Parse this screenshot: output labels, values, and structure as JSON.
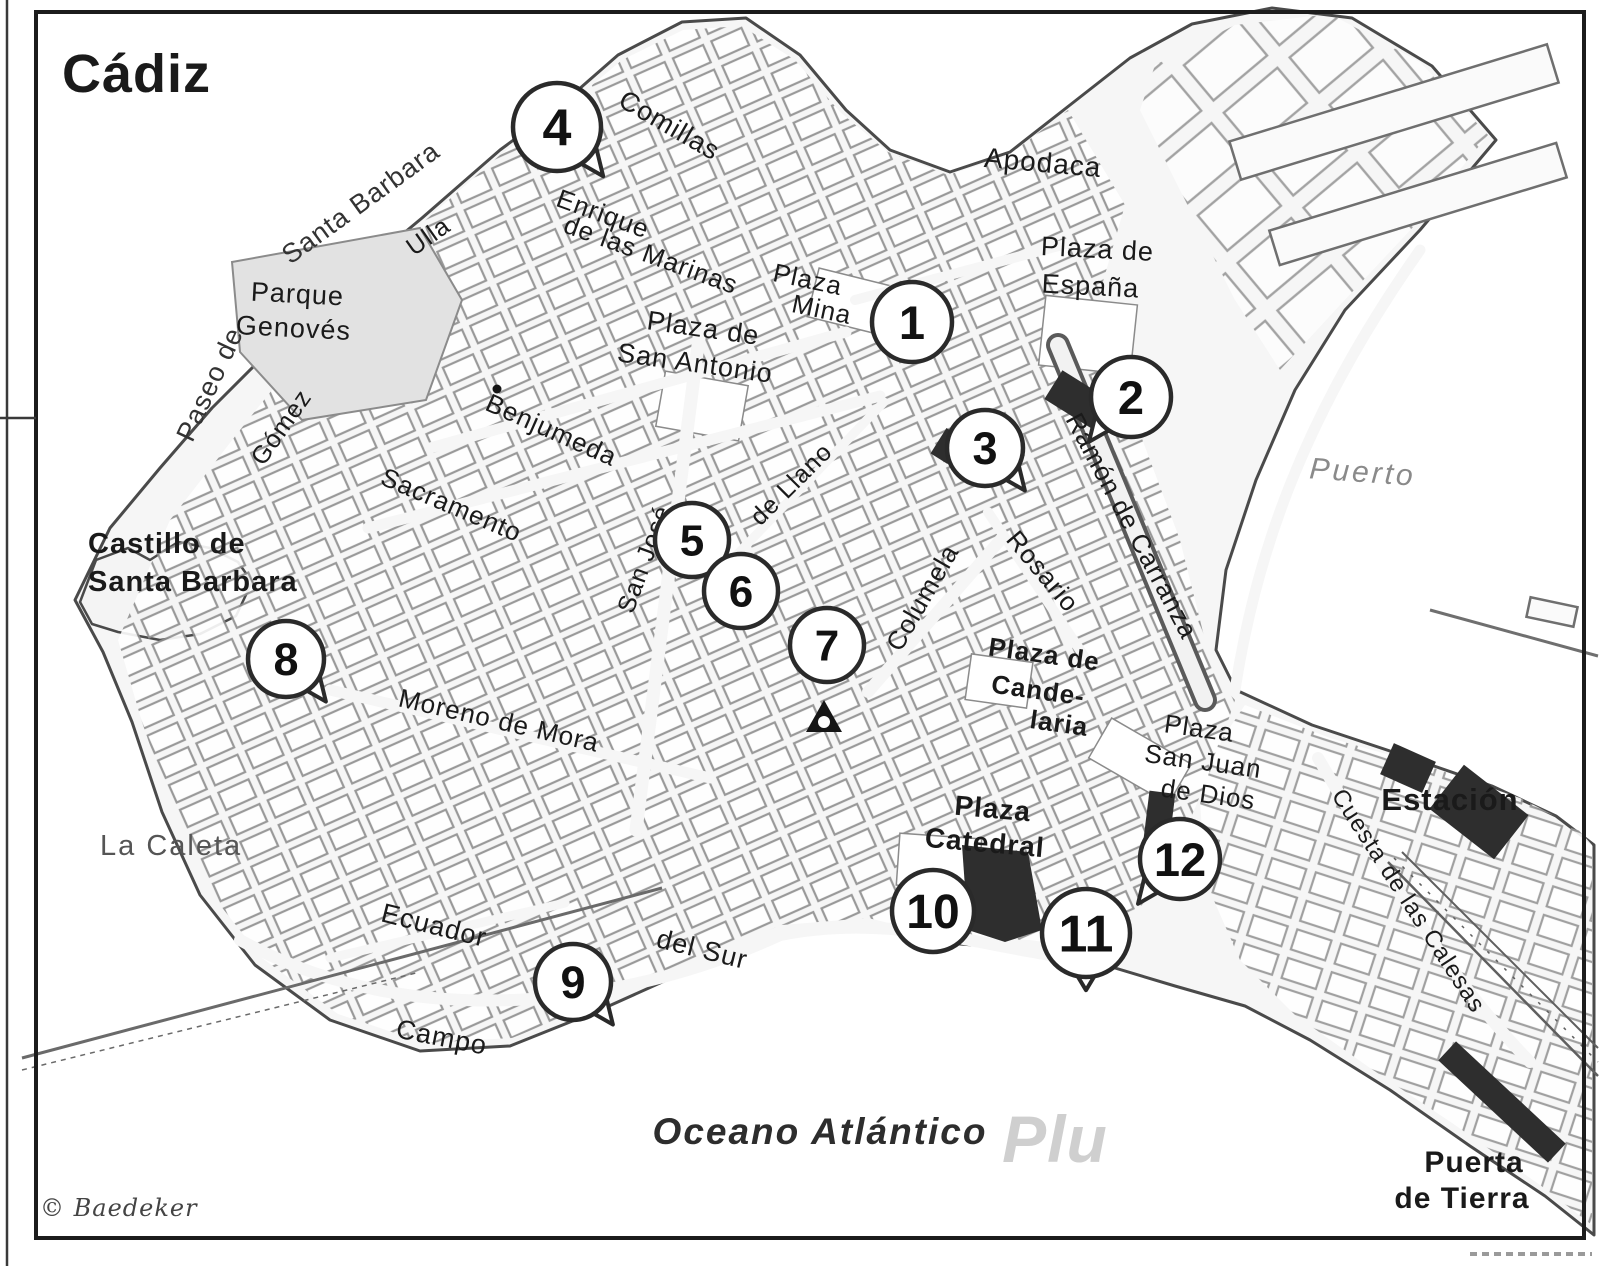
{
  "page": {
    "title": "Cádiz",
    "copyright": "© Baedeker",
    "watermark": "Plu"
  },
  "map": {
    "accent_color": "#2a2a2a",
    "sea_label": "Oceano Atlántico",
    "markers": [
      {
        "n": "1",
        "x": 912,
        "y": 322,
        "r": 40
      },
      {
        "n": "2",
        "x": 1131,
        "y": 397,
        "r": 40,
        "tail": "bl"
      },
      {
        "n": "3",
        "x": 985,
        "y": 448,
        "r": 38,
        "tail": "br"
      },
      {
        "n": "4",
        "x": 557,
        "y": 127,
        "r": 44,
        "tail": "br"
      },
      {
        "n": "5",
        "x": 692,
        "y": 540,
        "r": 37
      },
      {
        "n": "6",
        "x": 741,
        "y": 591,
        "r": 37
      },
      {
        "n": "7",
        "x": 827,
        "y": 645,
        "r": 37
      },
      {
        "n": "8",
        "x": 286,
        "y": 659,
        "r": 38,
        "tail": "br"
      },
      {
        "n": "9",
        "x": 573,
        "y": 982,
        "r": 38,
        "tail": "br"
      },
      {
        "n": "10",
        "x": 933,
        "y": 911,
        "r": 41
      },
      {
        "n": "11",
        "x": 1086,
        "y": 933,
        "r": 44,
        "tail": "b"
      },
      {
        "n": "12",
        "x": 1180,
        "y": 859,
        "r": 40,
        "tail": "bl"
      }
    ],
    "labels": [
      {
        "id": "title",
        "text": "Cádiz",
        "x": 62,
        "y": 92,
        "size": 54,
        "w": 700,
        "anchor": "start",
        "ls": 1
      },
      {
        "id": "paseo-de",
        "text": "Paseo de",
        "x": 218,
        "y": 388,
        "rot": -65,
        "size": 27,
        "fill": "#333333"
      },
      {
        "id": "santa-barbara-street",
        "text": "Santa Barbara",
        "x": 366,
        "y": 210,
        "rot": -36,
        "size": 27,
        "fill": "#333333"
      },
      {
        "id": "ulla",
        "text": "Ulla",
        "x": 433,
        "y": 243,
        "rot": -35,
        "size": 25
      },
      {
        "id": "comillas",
        "text": "Comillas",
        "x": 665,
        "y": 133,
        "rot": 30,
        "size": 27
      },
      {
        "id": "apodaca",
        "text": "Apodaca",
        "x": 1042,
        "y": 172,
        "rot": 5,
        "size": 28
      },
      {
        "id": "enrique",
        "text": "Enrique",
        "x": 600,
        "y": 222,
        "rot": 20,
        "size": 26
      },
      {
        "id": "de-las-marinas",
        "text": "de las Marinas",
        "x": 648,
        "y": 263,
        "rot": 20,
        "size": 26
      },
      {
        "id": "plaza-mina-line1",
        "text": "Plaza",
        "x": 806,
        "y": 288,
        "rot": 12,
        "size": 26
      },
      {
        "id": "plaza-mina-line2",
        "text": "Mina",
        "x": 820,
        "y": 318,
        "rot": 12,
        "size": 26
      },
      {
        "id": "plaza-espana-line1",
        "text": "Plaza de",
        "x": 1097,
        "y": 258,
        "rot": 3,
        "size": 27
      },
      {
        "id": "plaza-espana-line2",
        "text": "España",
        "x": 1090,
        "y": 295,
        "rot": 3,
        "size": 27
      },
      {
        "id": "plaza-san-antonio-line1",
        "text": "Plaza de",
        "x": 702,
        "y": 337,
        "rot": 8,
        "size": 27
      },
      {
        "id": "plaza-san-antonio-line2",
        "text": "San Antonio",
        "x": 694,
        "y": 372,
        "rot": 8,
        "size": 27
      },
      {
        "id": "parque-line1",
        "text": "Parque",
        "x": 297,
        "y": 303,
        "rot": 3,
        "size": 27
      },
      {
        "id": "parque-line2",
        "text": "Genovés",
        "x": 293,
        "y": 337,
        "rot": 3,
        "size": 27
      },
      {
        "id": "gomez",
        "text": "Gómez",
        "x": 288,
        "y": 432,
        "rot": -55,
        "size": 25
      },
      {
        "id": "benjumeda",
        "text": "Benjumeda",
        "x": 548,
        "y": 438,
        "rot": 24,
        "size": 26
      },
      {
        "id": "sacramento",
        "text": "Sacramento",
        "x": 448,
        "y": 513,
        "rot": 23,
        "size": 26
      },
      {
        "id": "san-jose",
        "text": "San José",
        "x": 652,
        "y": 562,
        "rot": -70,
        "size": 25
      },
      {
        "id": "de-llano",
        "text": "de Llano",
        "x": 797,
        "y": 490,
        "rot": -45,
        "size": 25
      },
      {
        "id": "columela",
        "text": "Columela",
        "x": 930,
        "y": 602,
        "rot": -60,
        "size": 26
      },
      {
        "id": "rosario",
        "text": "Rosario",
        "x": 1036,
        "y": 577,
        "rot": 50,
        "size": 26
      },
      {
        "id": "ramon-de-carranza",
        "text": "Ramón de Carranza",
        "x": 1124,
        "y": 530,
        "rot": 62,
        "size": 26
      },
      {
        "id": "puerto",
        "text": "Puerto",
        "x": 1362,
        "y": 482,
        "rot": 4,
        "size": 30,
        "it": 1,
        "fill": "#8a8a8a",
        "ls": 3
      },
      {
        "id": "castillo-line1",
        "text": "Castillo de",
        "x": 88,
        "y": 553,
        "size": 29,
        "w": 700,
        "anchor": "start"
      },
      {
        "id": "castillo-line2",
        "text": "Santa Barbara",
        "x": 88,
        "y": 591,
        "size": 29,
        "w": 700,
        "anchor": "start"
      },
      {
        "id": "moreno-de-mora",
        "text": "Moreno  de Mora",
        "x": 497,
        "y": 729,
        "rot": 13,
        "size": 26
      },
      {
        "id": "candelaria-line1",
        "text": "Plaza de",
        "x": 1043,
        "y": 663,
        "rot": 8,
        "size": 26,
        "w": 600
      },
      {
        "id": "candelaria-line2",
        "text": "Cande-",
        "x": 1037,
        "y": 699,
        "rot": 8,
        "size": 26,
        "w": 600
      },
      {
        "id": "candelaria-line3",
        "text": "laria",
        "x": 1058,
        "y": 732,
        "rot": 8,
        "size": 26,
        "w": 600
      },
      {
        "id": "san-juan-de-dios-line1",
        "text": "Plaza",
        "x": 1198,
        "y": 737,
        "rot": 8,
        "size": 26
      },
      {
        "id": "san-juan-de-dios-line2",
        "text": "San Juan",
        "x": 1202,
        "y": 770,
        "rot": 8,
        "size": 26
      },
      {
        "id": "san-juan-de-dios-line3",
        "text": "de Dios",
        "x": 1207,
        "y": 803,
        "rot": 8,
        "size": 26
      },
      {
        "id": "plaza-catedral-line1",
        "text": "Plaza",
        "x": 992,
        "y": 818,
        "rot": 5,
        "size": 28,
        "w": 600
      },
      {
        "id": "plaza-catedral-line2",
        "text": "Catedral",
        "x": 984,
        "y": 852,
        "rot": 5,
        "size": 28,
        "w": 600
      },
      {
        "id": "estacion",
        "text": "Estación",
        "x": 1450,
        "y": 810,
        "size": 31,
        "w": 700
      },
      {
        "id": "cuesta-de-las-calesas",
        "text": "Cuesta de las Calesas",
        "x": 1402,
        "y": 905,
        "rot": 57,
        "size": 24
      },
      {
        "id": "la-caleta",
        "text": "La Caleta",
        "x": 100,
        "y": 855,
        "size": 29,
        "fill": "#555555",
        "anchor": "start",
        "ls": 2
      },
      {
        "id": "ecuador",
        "text": "Ecuador",
        "x": 432,
        "y": 934,
        "rot": 14,
        "size": 27
      },
      {
        "id": "del-sur",
        "text": "del Sur",
        "x": 700,
        "y": 958,
        "rot": 14,
        "size": 27
      },
      {
        "id": "campo",
        "text": "Campo",
        "x": 440,
        "y": 1046,
        "rot": 11,
        "size": 27
      },
      {
        "id": "oceano-atlantico",
        "text": "Oceano Atlántico",
        "x": 820,
        "y": 1144,
        "size": 37,
        "it": 1,
        "w": 600,
        "fill": "#2d2d2d",
        "ls": 2
      },
      {
        "id": "puerta-de-tierra-line1",
        "text": "Puerta",
        "x": 1474,
        "y": 1172,
        "size": 30,
        "w": 700
      },
      {
        "id": "puerta-de-tierra-line2",
        "text": "de Tierra",
        "x": 1462,
        "y": 1208,
        "size": 30,
        "w": 700
      },
      {
        "id": "copyright",
        "text": "© Baedeker",
        "x": 40,
        "y": 1216,
        "size": 24,
        "it": 1,
        "fill": "#444444",
        "anchor": "start",
        "serif": 1
      },
      {
        "id": "watermark",
        "text": "Plu",
        "x": 1055,
        "y": 1162,
        "size": 66,
        "it": 1,
        "w": 700,
        "fill": "#cfcfcf"
      }
    ]
  }
}
